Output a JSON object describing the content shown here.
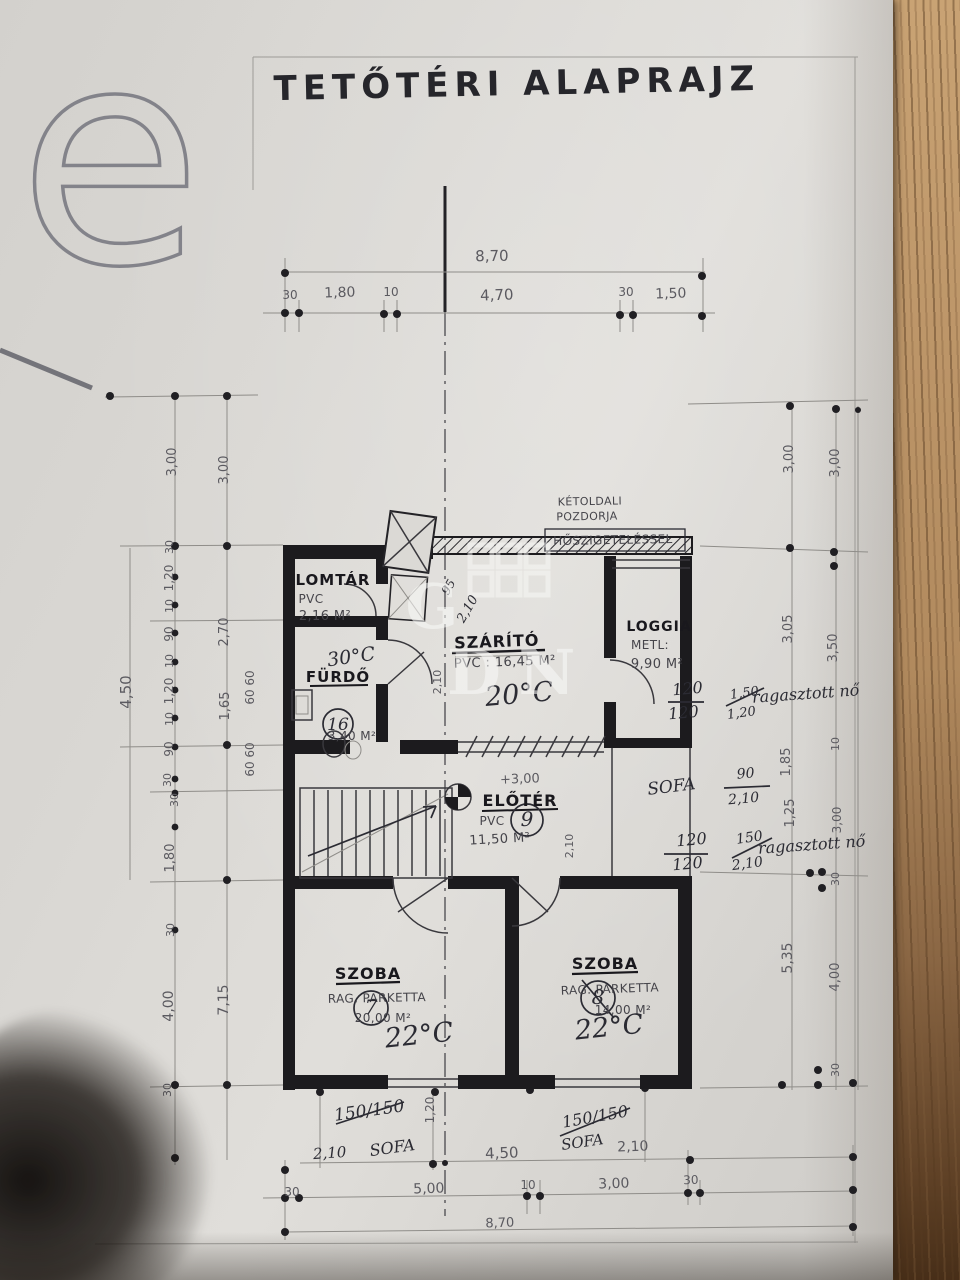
{
  "title": "TETŐTÉRI ALAPRAJZ",
  "watermark": {
    "corner_letter": "e",
    "center_letters": "GDN"
  },
  "rooms": [
    {
      "name": "LOMTÁR",
      "floor": "PVC",
      "area": "2,16 M²"
    },
    {
      "name": "FÜRDŐ",
      "area": "3,40 M²",
      "temp": "30°C",
      "number": "16"
    },
    {
      "name": "SZÁRÍTÓ",
      "floor": "PVC",
      "area": "16,45 M²",
      "temp": "20°C"
    },
    {
      "name": "LOGGIA",
      "floor": "METL:",
      "area": "9,90 M²"
    },
    {
      "name": "ELŐTÉR",
      "floor": "PVC",
      "area": "11,50 M²",
      "number": "9",
      "level": "+3,00"
    },
    {
      "name": "SZOBA",
      "floor": "RAG. PARKETTA",
      "area": "20,00 M²",
      "temp": "22°C",
      "number": "7"
    },
    {
      "name": "SZOBA",
      "floor": "RAG. PARKETTA",
      "area": "14,00 M²",
      "temp": "22°C",
      "number": "8"
    }
  ],
  "insulation_note": "KÉTOLDALI POZDORJA HŐSZIGETELÉSSEL",
  "plan": {
    "labels": [
      {
        "t": "8,70",
        "x": 492,
        "y": 261,
        "s": 15,
        "r": -1,
        "c": "dim"
      },
      {
        "t": "30",
        "x": 290,
        "y": 299,
        "s": 12,
        "c": "dim"
      },
      {
        "t": "1,80",
        "x": 340,
        "y": 297,
        "s": 14,
        "r": -2,
        "c": "dim"
      },
      {
        "t": "10",
        "x": 391,
        "y": 296,
        "s": 12,
        "c": "dim"
      },
      {
        "t": "4,70",
        "x": 497,
        "y": 300,
        "s": 15,
        "r": -2,
        "c": "dim"
      },
      {
        "t": "30",
        "x": 626,
        "y": 296,
        "s": 12,
        "c": "dim"
      },
      {
        "t": "1,50",
        "x": 671,
        "y": 298,
        "s": 14,
        "r": -2,
        "c": "dim"
      },
      {
        "t": "4,50",
        "x": 502,
        "y": 1158,
        "s": 15,
        "r": -2,
        "c": "dim"
      },
      {
        "t": "2,10",
        "x": 633,
        "y": 1151,
        "s": 14,
        "r": -2,
        "c": "dim"
      },
      {
        "t": "30",
        "x": 292,
        "y": 1196,
        "s": 12,
        "c": "dim"
      },
      {
        "t": "5,00",
        "x": 429,
        "y": 1193,
        "s": 14,
        "r": -2,
        "c": "dim"
      },
      {
        "t": "10",
        "x": 528,
        "y": 1189,
        "s": 12,
        "c": "dim"
      },
      {
        "t": "3,00",
        "x": 614,
        "y": 1188,
        "s": 14,
        "r": -2,
        "c": "dim"
      },
      {
        "t": "30",
        "x": 691,
        "y": 1184,
        "s": 12,
        "r": -2,
        "c": "dim"
      },
      {
        "t": "8,70",
        "x": 500,
        "y": 1227,
        "s": 13,
        "r": -2,
        "c": "dim"
      },
      {
        "t": "1,20",
        "x": 434,
        "y": 1110,
        "s": 12,
        "r": -90,
        "c": "dim"
      },
      {
        "t": "4,50",
        "x": 131,
        "y": 692,
        "s": 15,
        "r": -90,
        "c": "dim"
      },
      {
        "t": "3,00",
        "x": 176,
        "y": 462,
        "s": 13,
        "r": -90,
        "c": "dim"
      },
      {
        "t": "3,00",
        "x": 228,
        "y": 470,
        "s": 13,
        "r": -90,
        "c": "dim"
      },
      {
        "t": "30",
        "x": 173,
        "y": 547,
        "s": 11,
        "r": -90,
        "c": "dim"
      },
      {
        "t": "1,20",
        "x": 173,
        "y": 578,
        "s": 12,
        "r": -90,
        "c": "dim"
      },
      {
        "t": "10",
        "x": 173,
        "y": 606,
        "s": 11,
        "r": -90,
        "c": "dim"
      },
      {
        "t": "90",
        "x": 173,
        "y": 634,
        "s": 12,
        "r": -90,
        "c": "dim"
      },
      {
        "t": "10",
        "x": 173,
        "y": 661,
        "s": 11,
        "r": -90,
        "c": "dim"
      },
      {
        "t": "1,20",
        "x": 173,
        "y": 691,
        "s": 12,
        "r": -90,
        "c": "dim"
      },
      {
        "t": "10",
        "x": 173,
        "y": 719,
        "s": 11,
        "r": -90,
        "c": "dim"
      },
      {
        "t": "90",
        "x": 173,
        "y": 749,
        "s": 12,
        "r": -90,
        "c": "dim"
      },
      {
        "t": "30",
        "x": 171,
        "y": 780,
        "s": 11,
        "r": -90,
        "c": "dim"
      },
      {
        "t": "30",
        "x": 178,
        "y": 800,
        "s": 11,
        "r": -90,
        "c": "dim"
      },
      {
        "t": "1,80",
        "x": 174,
        "y": 858,
        "s": 13,
        "r": -90,
        "c": "dim"
      },
      {
        "t": "30",
        "x": 174,
        "y": 930,
        "s": 11,
        "r": -90,
        "c": "dim"
      },
      {
        "t": "4,00",
        "x": 173,
        "y": 1006,
        "s": 14,
        "r": -90,
        "c": "dim"
      },
      {
        "t": "30",
        "x": 171,
        "y": 1090,
        "s": 11,
        "r": -90,
        "c": "dim"
      },
      {
        "t": "2,70",
        "x": 228,
        "y": 632,
        "s": 13,
        "r": -90,
        "c": "dim"
      },
      {
        "t": "1,65",
        "x": 229,
        "y": 706,
        "s": 13,
        "r": -90,
        "c": "dim"
      },
      {
        "t": "7,15",
        "x": 228,
        "y": 1000,
        "s": 14,
        "r": -90,
        "c": "dim"
      },
      {
        "t": "60",
        "x": 254,
        "y": 678,
        "s": 12,
        "r": -90,
        "c": "dim"
      },
      {
        "t": "60",
        "x": 254,
        "y": 697,
        "s": 12,
        "r": -90,
        "c": "dim"
      },
      {
        "t": "60",
        "x": 254,
        "y": 750,
        "s": 12,
        "r": -90,
        "c": "dim"
      },
      {
        "t": "60",
        "x": 254,
        "y": 769,
        "s": 12,
        "r": -90,
        "c": "dim"
      },
      {
        "t": "3,00",
        "x": 793,
        "y": 459,
        "s": 13,
        "r": -90,
        "c": "dim"
      },
      {
        "t": "3,00",
        "x": 839,
        "y": 463,
        "s": 13,
        "r": -90,
        "c": "dim"
      },
      {
        "t": "3,05",
        "x": 792,
        "y": 629,
        "s": 13,
        "r": -90,
        "c": "dim"
      },
      {
        "t": "3,50",
        "x": 837,
        "y": 648,
        "s": 13,
        "r": -90,
        "c": "dim"
      },
      {
        "t": "10",
        "x": 839,
        "y": 744,
        "s": 11,
        "r": -90,
        "c": "dim"
      },
      {
        "t": "1,85",
        "x": 790,
        "y": 762,
        "s": 13,
        "r": -90,
        "c": "dim"
      },
      {
        "t": "1,25",
        "x": 794,
        "y": 813,
        "s": 13,
        "r": -90,
        "c": "dim"
      },
      {
        "t": "3,00",
        "x": 841,
        "y": 820,
        "s": 12,
        "r": -90,
        "c": "dim"
      },
      {
        "t": "30",
        "x": 839,
        "y": 879,
        "s": 11,
        "r": -90,
        "c": "dim"
      },
      {
        "t": "5,35",
        "x": 792,
        "y": 958,
        "s": 14,
        "r": -90,
        "c": "dim"
      },
      {
        "t": "4,00",
        "x": 839,
        "y": 977,
        "s": 13,
        "r": -90,
        "c": "dim"
      },
      {
        "t": "30",
        "x": 839,
        "y": 1070,
        "s": 11,
        "r": -90,
        "c": "dim"
      },
      {
        "t": "LOMTÁR",
        "x": 333,
        "y": 585,
        "s": 15,
        "c": "room",
        "n": "room-lomtar"
      },
      {
        "t": "PVC",
        "x": 311,
        "y": 603,
        "s": 12,
        "c": "sub"
      },
      {
        "t": "2,16 M²",
        "x": 325,
        "y": 620,
        "s": 13,
        "c": "sub"
      },
      {
        "t": "FÜRDŐ",
        "x": 338,
        "y": 682,
        "s": 15,
        "c": "room",
        "n": "room-furdo"
      },
      {
        "t": "3,40 M²",
        "x": 352,
        "y": 740,
        "s": 12,
        "c": "sub"
      },
      {
        "t": "16",
        "x": 338,
        "y": 730,
        "s": 17,
        "c": "hw"
      },
      {
        "t": "SZÁRÍTÓ",
        "x": 497,
        "y": 647,
        "s": 16,
        "r": -2,
        "c": "room",
        "n": "room-szarito"
      },
      {
        "t": "PVC : 16,45 M²",
        "x": 505,
        "y": 666,
        "s": 13,
        "r": -2,
        "c": "sub"
      },
      {
        "t": "20°C",
        "x": 520,
        "y": 703,
        "s": 27,
        "r": -5,
        "c": "hw"
      },
      {
        "t": "30°C",
        "x": 352,
        "y": 663,
        "s": 19,
        "r": -8,
        "c": "hw"
      },
      {
        "t": "LOGGIA",
        "x": 659,
        "y": 631,
        "s": 14,
        "c": "room",
        "n": "room-loggia"
      },
      {
        "t": "METL:",
        "x": 650,
        "y": 649,
        "s": 12,
        "c": "sub"
      },
      {
        "t": "9,90 M²",
        "x": 657,
        "y": 668,
        "s": 13,
        "c": "sub"
      },
      {
        "t": "KÉTOLDALI",
        "x": 590,
        "y": 505,
        "s": 11,
        "r": -1,
        "c": "sub"
      },
      {
        "t": "POZDORJA",
        "x": 587,
        "y": 520,
        "s": 11,
        "r": -1,
        "c": "sub"
      },
      {
        "t": "HŐSZIGETELÉSSEL",
        "x": 613,
        "y": 544,
        "s": 12,
        "r": -1,
        "c": "sub"
      },
      {
        "t": "ELŐTÉR",
        "x": 520,
        "y": 806,
        "s": 16,
        "c": "room",
        "n": "room-eloter"
      },
      {
        "t": "PVC",
        "x": 492,
        "y": 825,
        "s": 12,
        "c": "sub"
      },
      {
        "t": "11,50 M²",
        "x": 500,
        "y": 843,
        "s": 13,
        "r": -3,
        "c": "sub"
      },
      {
        "t": "+3,00",
        "x": 520,
        "y": 783,
        "s": 13,
        "r": -2,
        "c": "dim",
        "n": "level-mark"
      },
      {
        "t": "9",
        "x": 527,
        "y": 826,
        "s": 20,
        "c": "hw"
      },
      {
        "t": "SZOBA",
        "x": 368,
        "y": 979,
        "s": 16,
        "c": "room",
        "n": "room-szoba-left"
      },
      {
        "t": "RAG. PARKETTA",
        "x": 377,
        "y": 1002,
        "s": 12,
        "r": -1,
        "c": "sub"
      },
      {
        "t": "20,00 M²",
        "x": 383,
        "y": 1022,
        "s": 12,
        "c": "sub"
      },
      {
        "t": "7",
        "x": 371,
        "y": 1014,
        "s": 20,
        "c": "hw"
      },
      {
        "t": "22°C",
        "x": 420,
        "y": 1044,
        "s": 27,
        "r": -6,
        "c": "hw"
      },
      {
        "t": "SZOBA",
        "x": 605,
        "y": 969,
        "s": 16,
        "c": "room",
        "n": "room-szoba-right"
      },
      {
        "t": "RAG. PARKETTA",
        "x": 610,
        "y": 993,
        "s": 12,
        "r": -2,
        "c": "sub"
      },
      {
        "t": "14,00 M²",
        "x": 623,
        "y": 1014,
        "s": 12,
        "c": "sub"
      },
      {
        "t": "8",
        "x": 598,
        "y": 1004,
        "s": 20,
        "c": "hw"
      },
      {
        "t": "22°C",
        "x": 610,
        "y": 1036,
        "s": 27,
        "r": -6,
        "c": "hw"
      },
      {
        "t": "95",
        "x": 452,
        "y": 589,
        "s": 12,
        "r": -60,
        "c": "hw"
      },
      {
        "t": "2,10",
        "x": 471,
        "y": 611,
        "s": 13,
        "r": -60,
        "c": "hw"
      },
      {
        "t": "2,10",
        "x": 441,
        "y": 682,
        "s": 11,
        "r": -90,
        "c": "dim"
      },
      {
        "t": "2,10",
        "x": 573,
        "y": 846,
        "s": 11,
        "r": -90,
        "c": "dim"
      },
      {
        "t": "120",
        "x": 688,
        "y": 694,
        "s": 16,
        "r": -5,
        "c": "hw"
      },
      {
        "t": "120",
        "x": 684,
        "y": 718,
        "s": 16,
        "r": -5,
        "c": "hw"
      },
      {
        "t": "1,50",
        "x": 745,
        "y": 697,
        "s": 13,
        "r": -8,
        "c": "hw"
      },
      {
        "t": "1,20",
        "x": 742,
        "y": 717,
        "s": 13,
        "r": -8,
        "c": "hw"
      },
      {
        "t": "ragasztott nő",
        "x": 806,
        "y": 699,
        "s": 16,
        "r": -4,
        "c": "hw"
      },
      {
        "t": "SOFA",
        "x": 672,
        "y": 792,
        "s": 17,
        "r": -7,
        "c": "hw"
      },
      {
        "t": "90",
        "x": 746,
        "y": 778,
        "s": 14,
        "r": -5,
        "c": "hw"
      },
      {
        "t": "2,10",
        "x": 744,
        "y": 803,
        "s": 14,
        "r": -5,
        "c": "hw"
      },
      {
        "t": "120",
        "x": 692,
        "y": 845,
        "s": 16,
        "r": -5,
        "c": "hw"
      },
      {
        "t": "120",
        "x": 688,
        "y": 869,
        "s": 16,
        "r": -5,
        "c": "hw"
      },
      {
        "t": "150",
        "x": 750,
        "y": 842,
        "s": 14,
        "r": -8,
        "c": "hw"
      },
      {
        "t": "2,10",
        "x": 748,
        "y": 868,
        "s": 14,
        "r": -8,
        "c": "hw"
      },
      {
        "t": "ragasztott nő",
        "x": 812,
        "y": 850,
        "s": 16,
        "r": -4,
        "c": "hw"
      },
      {
        "t": "150/150",
        "x": 370,
        "y": 1116,
        "s": 17,
        "r": -8,
        "c": "hw"
      },
      {
        "t": "2,10",
        "x": 330,
        "y": 1158,
        "s": 15,
        "r": -4,
        "c": "hw"
      },
      {
        "t": "SOFA",
        "x": 393,
        "y": 1153,
        "s": 16,
        "r": -8,
        "c": "hw"
      },
      {
        "t": "150/150",
        "x": 596,
        "y": 1122,
        "s": 16,
        "r": -10,
        "c": "hw"
      },
      {
        "t": "SOFA",
        "x": 583,
        "y": 1147,
        "s": 15,
        "r": -8,
        "c": "hw"
      },
      {
        "t": "G",
        "x": 432,
        "y": 628,
        "s": 62,
        "c": "wm"
      },
      {
        "t": "D",
        "x": 474,
        "y": 694,
        "s": 62,
        "c": "wm"
      },
      {
        "t": "N",
        "x": 547,
        "y": 694,
        "s": 62,
        "c": "wm"
      }
    ]
  }
}
